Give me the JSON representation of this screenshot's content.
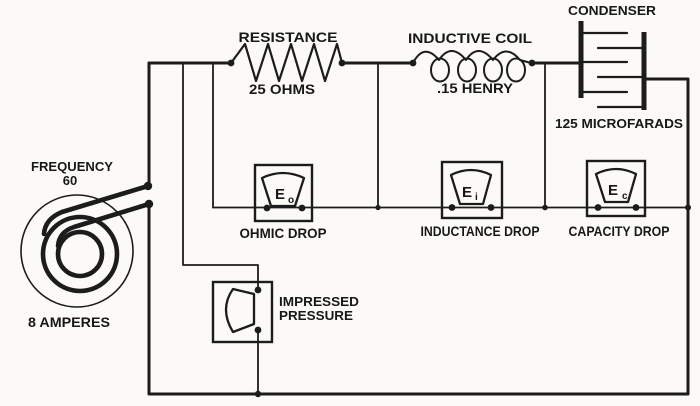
{
  "figure": {
    "kind": "series AC circuit schematic",
    "ink_color": "#1c1c1c",
    "paper_color": "#fbfaf6"
  },
  "source": {
    "frequency_label": "FREQUENCY",
    "frequency_value": "60",
    "current_label": "8 AMPERES"
  },
  "resistor": {
    "label": "RESISTANCE",
    "value": "25 OHMS"
  },
  "inductor": {
    "label": "INDUCTIVE COIL",
    "value": ".15 HENRY"
  },
  "condenser": {
    "label": "CONDENSER",
    "value": "125 MICROFARADS"
  },
  "meters": {
    "ohmic": {
      "symbol": "E",
      "subscript": "o",
      "caption": "OHMIC DROP"
    },
    "inductance": {
      "symbol": "E",
      "subscript": "i",
      "caption": "INDUCTANCE DROP"
    },
    "capacity": {
      "symbol": "E",
      "subscript": "c",
      "caption": "CAPACITY DROP"
    },
    "impressed": {
      "caption_line1": "IMPRESSED",
      "caption_line2": "PRESSURE"
    }
  }
}
